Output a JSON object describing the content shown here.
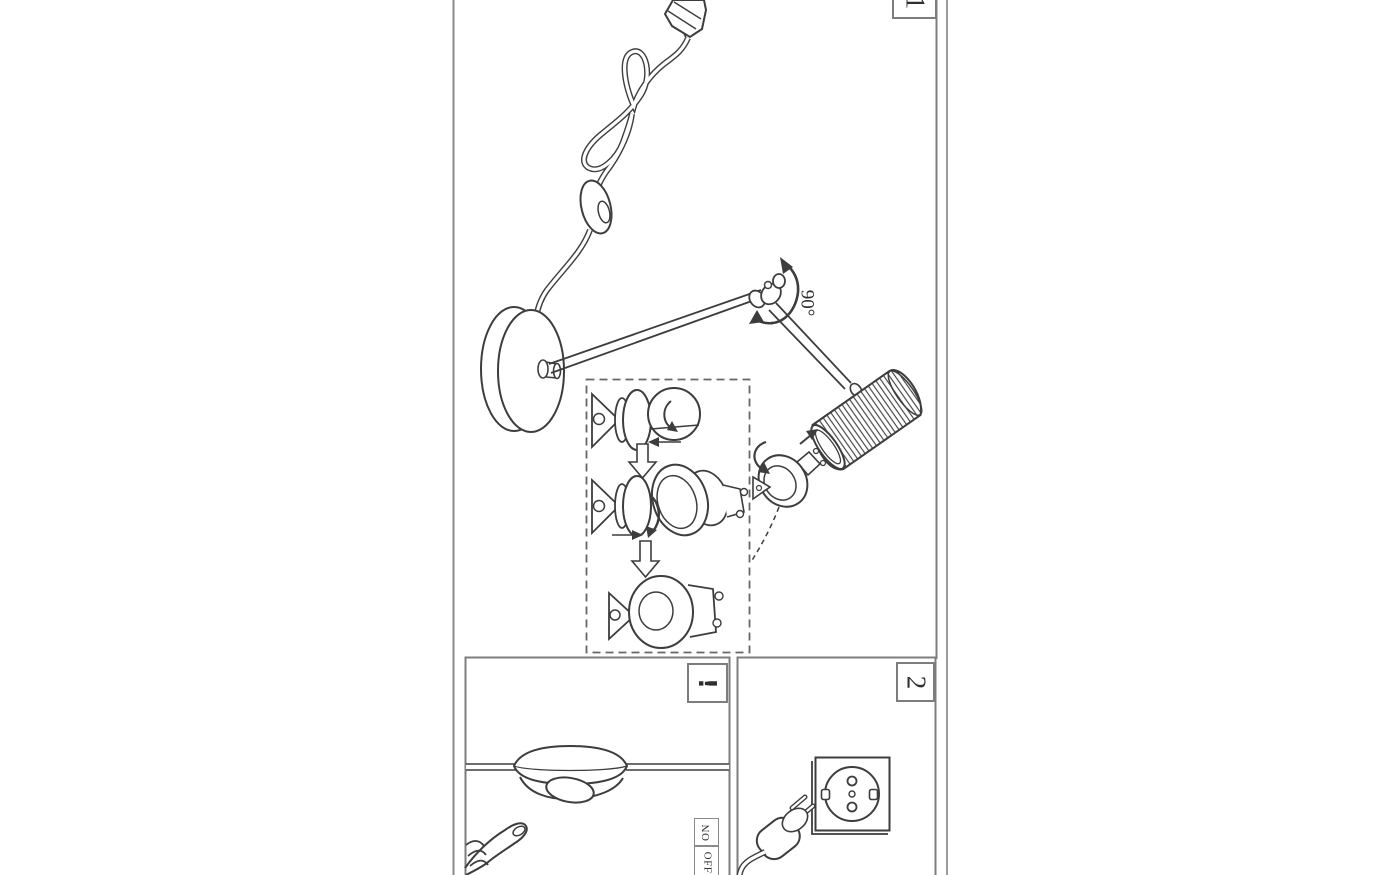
{
  "labels": {
    "panel_1_number": "1",
    "panel_2_number": "2",
    "rotation_angle": "90°",
    "warning_mark": "!",
    "switch_on": "ON",
    "switch_off": "OFF"
  },
  "colors": {
    "background": "#ffffff",
    "ink": "#3d3d3d",
    "panel_border": "#7d7d7d",
    "page_edge": "#9a9a9a"
  }
}
